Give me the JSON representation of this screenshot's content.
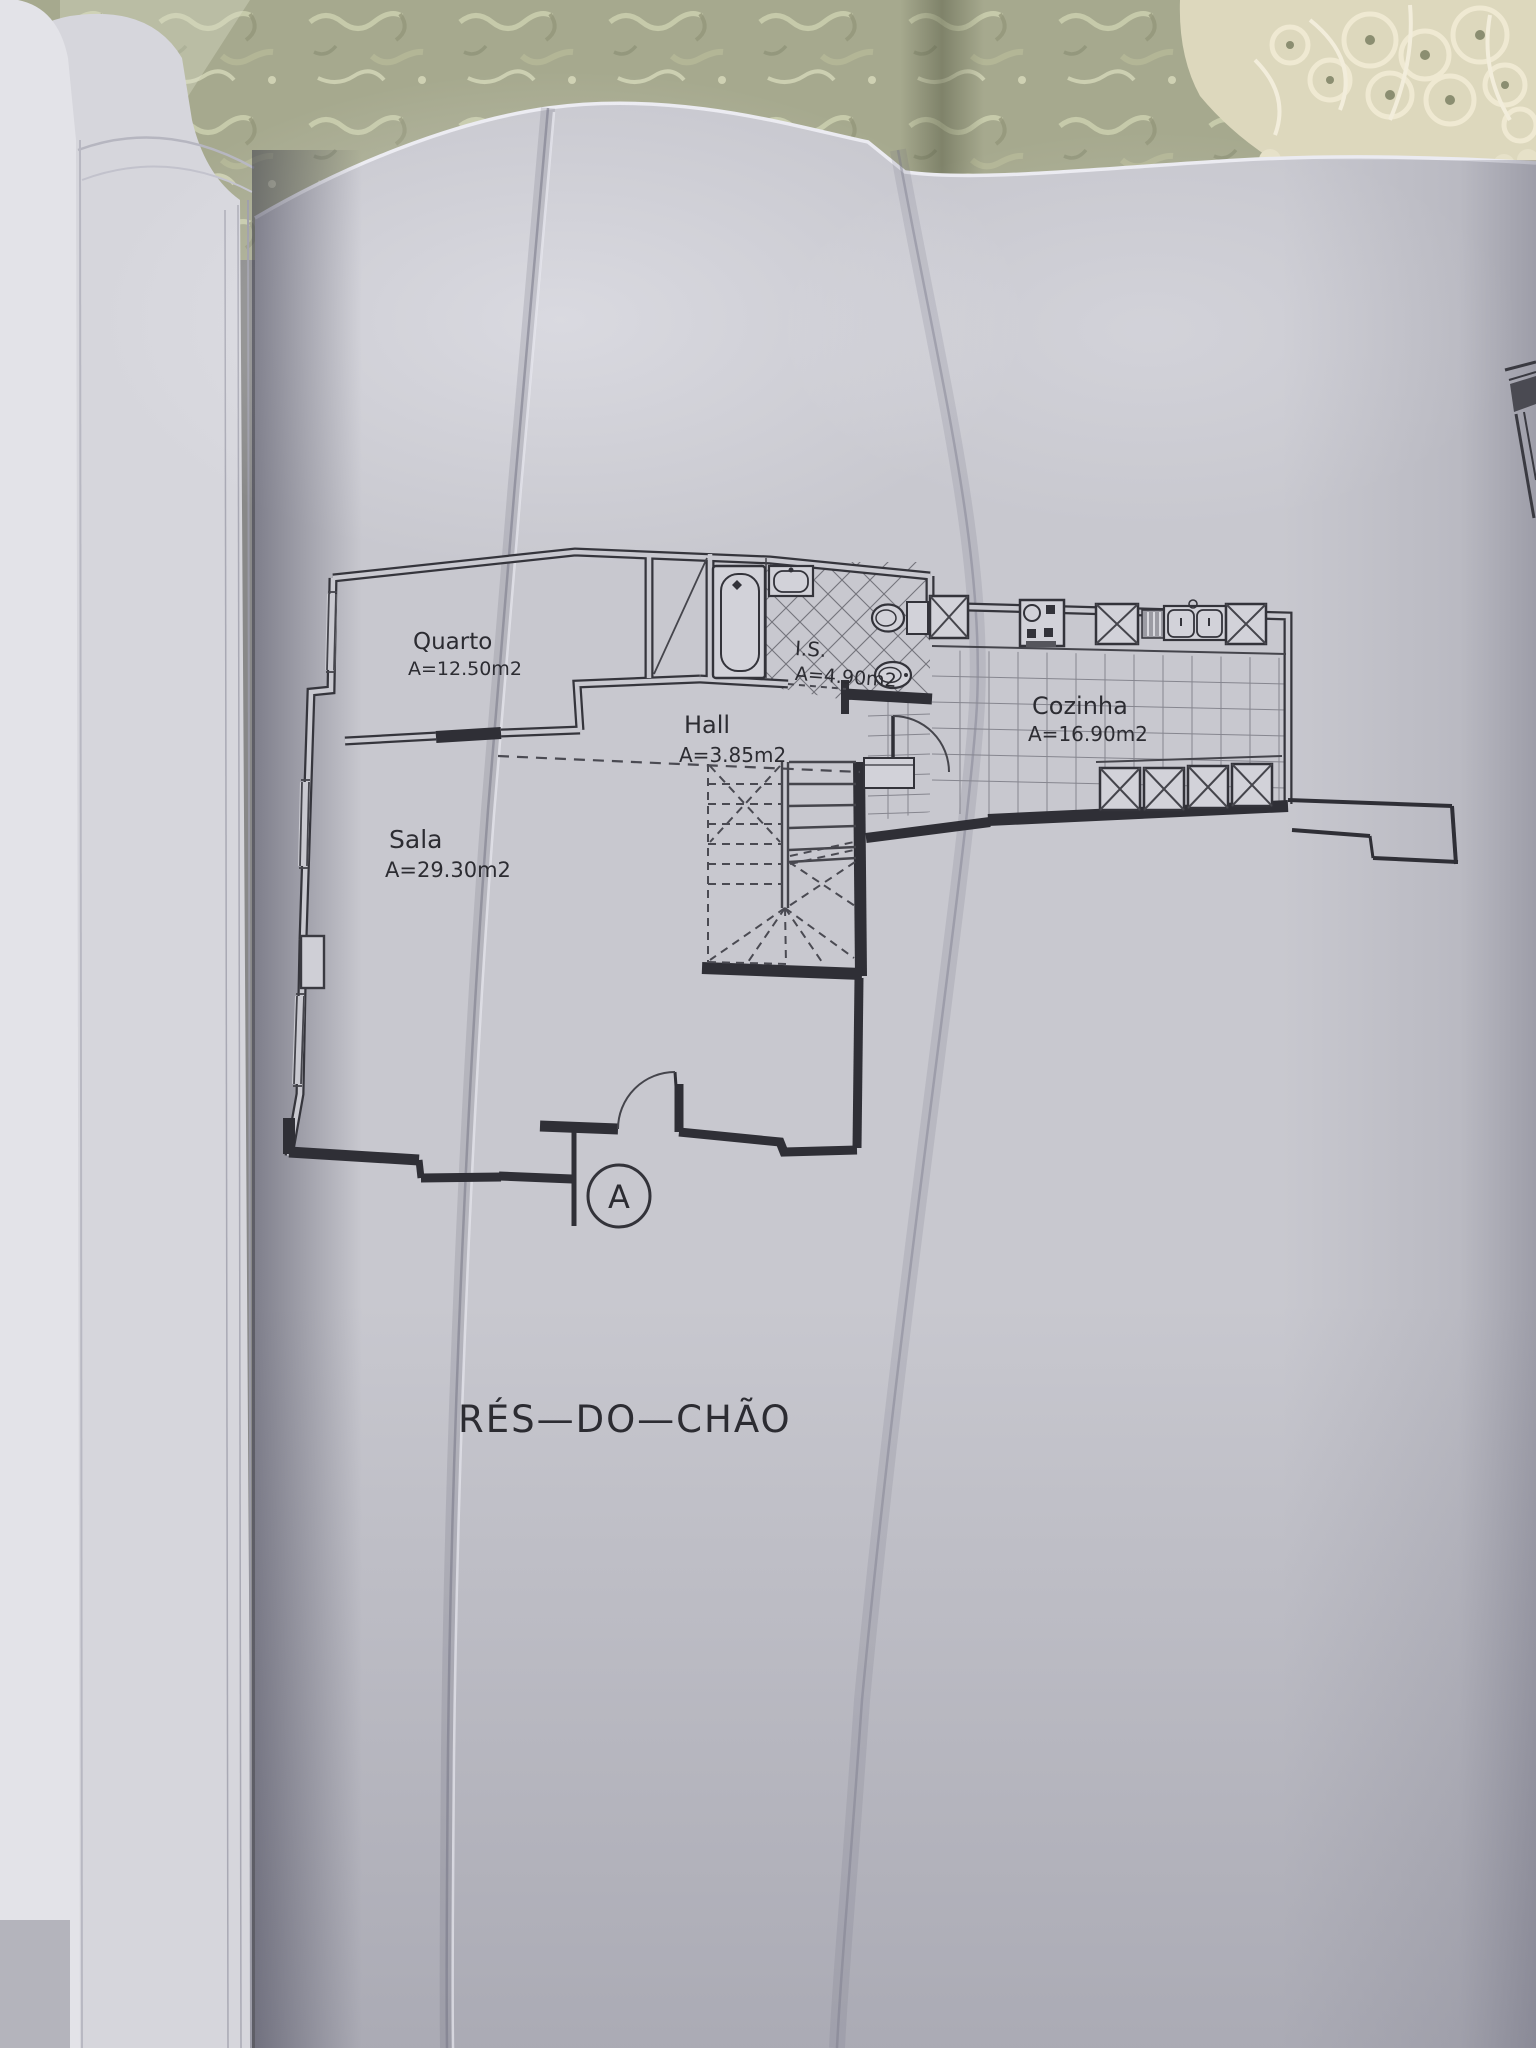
{
  "floor_plan": {
    "title": "RÉS—DO—CHÃO",
    "section_marker": "A",
    "rooms": [
      {
        "name": "Quarto",
        "area": "A=12.50m2"
      },
      {
        "name": "Sala",
        "area": "A=29.30m2"
      },
      {
        "name": "Hall",
        "area": "A=3.85m2"
      },
      {
        "name": "I.S.",
        "area": "A=4.90m2"
      },
      {
        "name": "Cozinha",
        "area": "A=16.90m2"
      }
    ],
    "colors": {
      "paper": "#c8c8cf",
      "ink": "#303036",
      "tablecloth": "#a6a98e",
      "doily": "#e2ddc2"
    },
    "icons": [
      "bathtub-icon",
      "washbasin-icon",
      "toilet-icon",
      "bidet-icon",
      "stove-icon",
      "kitchen-sink-icon",
      "appliance-box-icon",
      "dish-drainer-icon",
      "stairs-icon",
      "door-swing-icon",
      "window-icon",
      "wardrobe-icon"
    ]
  }
}
